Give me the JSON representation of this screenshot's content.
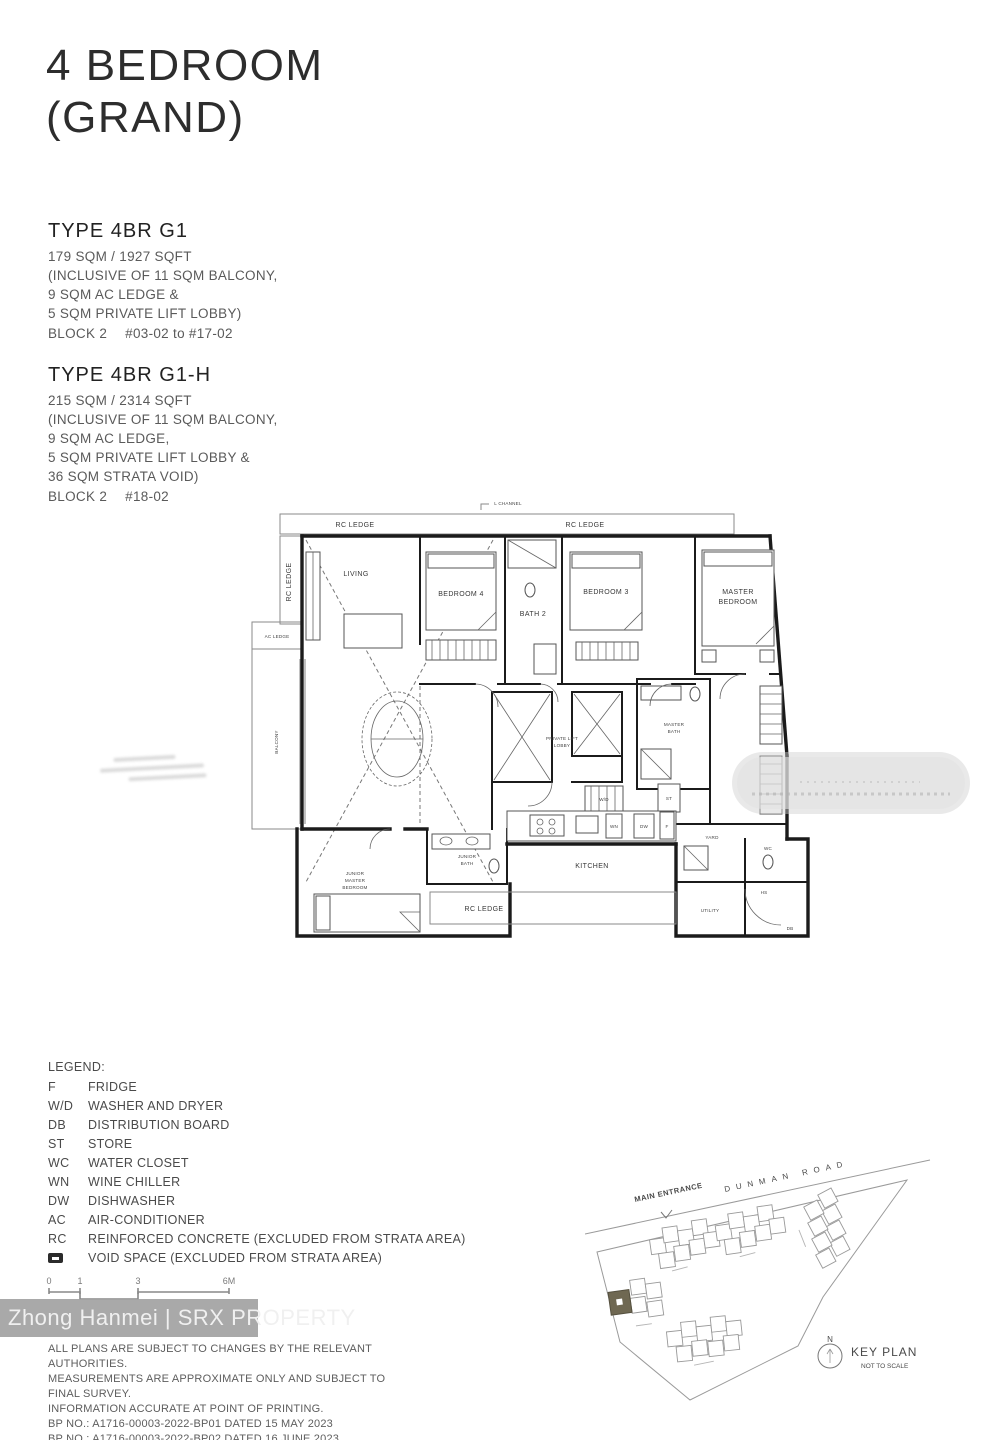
{
  "title": {
    "line1": "4 BEDROOM",
    "line2": "(GRAND)"
  },
  "types": [
    {
      "name": "TYPE 4BR G1",
      "lines": [
        "179 SQM / 1927 SQFT",
        "(INCLUSIVE OF 11 SQM BALCONY,",
        "9 SQM AC LEDGE &",
        "5 SQM PRIVATE LIFT LOBBY)"
      ],
      "block": "BLOCK 2",
      "units": "#03-02 to #17-02"
    },
    {
      "name": "TYPE 4BR G1-H",
      "lines": [
        "215 SQM / 2314 SQFT",
        "(INCLUSIVE OF 11 SQM BALCONY,",
        "9 SQM AC LEDGE,",
        "5 SQM PRIVATE LIFT LOBBY &",
        "36 SQM STRATA VOID)"
      ],
      "block": "BLOCK 2",
      "units": "#18-02"
    }
  ],
  "plan": {
    "labels": {
      "l_channel": "L CHANNEL",
      "rc_ledge": "RC LEDGE",
      "ac_ledge": "AC LEDGE",
      "balcony": "BALCONY",
      "living": "LIVING",
      "bedroom4": "BEDROOM 4",
      "bath2": "BATH 2",
      "bedroom3": "BEDROOM 3",
      "master_l1": "MASTER",
      "master_l2": "BEDROOM",
      "masterbath_l1": "MASTER",
      "masterbath_l2": "BATH",
      "pll_l1": "PRIVATE LIFT",
      "pll_l2": "LOBBY",
      "jm_l1": "JUNIOR",
      "jm_l2": "MASTER",
      "jm_l3": "BEDROOM",
      "jbath_l1": "JUNIOR",
      "jbath_l2": "BATH",
      "kitchen": "KITCHEN",
      "yard": "YARD",
      "utility": "UTILITY",
      "hs": "HS",
      "wc": "WC",
      "f": "F",
      "dw": "DW",
      "wn": "WN",
      "wd": "W/D",
      "st": "ST",
      "db": "DB"
    }
  },
  "legend": {
    "title": "LEGEND:",
    "items": [
      {
        "key": "F",
        "desc": "FRIDGE"
      },
      {
        "key": "W/D",
        "desc": "WASHER AND DRYER"
      },
      {
        "key": "DB",
        "desc": "DISTRIBUTION BOARD"
      },
      {
        "key": "ST",
        "desc": "STORE"
      },
      {
        "key": "WC",
        "desc": "WATER CLOSET"
      },
      {
        "key": "WN",
        "desc": "WINE CHILLER"
      },
      {
        "key": "DW",
        "desc": "DISHWASHER"
      },
      {
        "key": "AC",
        "desc": "AIR-CONDITIONER"
      },
      {
        "key": "RC",
        "desc": "REINFORCED CONCRETE (EXCLUDED FROM STRATA AREA)"
      }
    ],
    "void_desc": "VOID SPACE (EXCLUDED FROM STRATA AREA)"
  },
  "scalebar": {
    "ticks": [
      "0",
      "1",
      "3",
      "6M"
    ]
  },
  "watermark": "Zhong Hanmei | SRX PROPERTY",
  "disclaimer": [
    "ALL PLANS ARE SUBJECT TO CHANGES BY THE RELEVANT AUTHORITIES.",
    "MEASUREMENTS ARE APPROXIMATE ONLY AND SUBJECT TO FINAL SURVEY.",
    "INFORMATION ACCURATE AT POINT OF PRINTING.",
    "BP NO.: A1716-00003-2022-BP01 DATED 15 MAY 2023",
    "BP NO.: A1716-00003-2022-BP02 DATED 16 JUNE 2023"
  ],
  "keyplan": {
    "main_entrance": "MAIN ENTRANCE",
    "road": "DUNMAN ROAD",
    "north": "N",
    "title": "KEY PLAN",
    "subtitle": "NOT TO SCALE"
  },
  "colors": {
    "highlight_block": "#6f6852",
    "watermark_band": "#a2a2a2",
    "wall": "#1b1b1b"
  }
}
